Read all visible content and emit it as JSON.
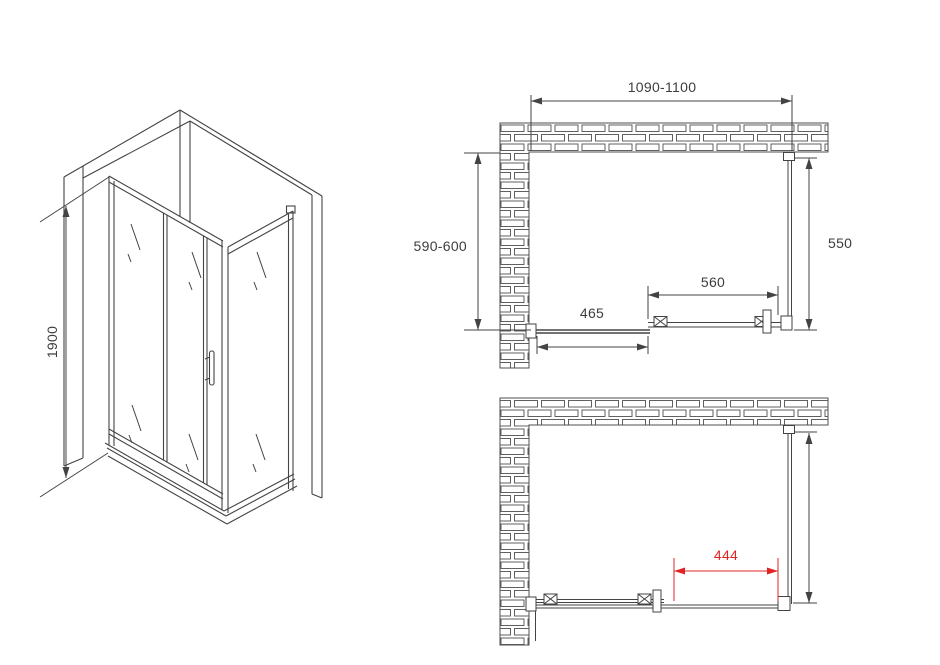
{
  "drawing": {
    "isometric": {
      "height_label": "1900"
    },
    "plan_closed": {
      "width_label": "1090-1100",
      "depth_label": "590-600",
      "side_panel_label": "550",
      "sliding_door_label": "560",
      "fixed_panel_label": "465"
    },
    "plan_open": {
      "opening_label": "444"
    },
    "colors": {
      "line": "#434343",
      "brick_line": "#4f4f4f",
      "accent_red": "#e02424"
    }
  }
}
